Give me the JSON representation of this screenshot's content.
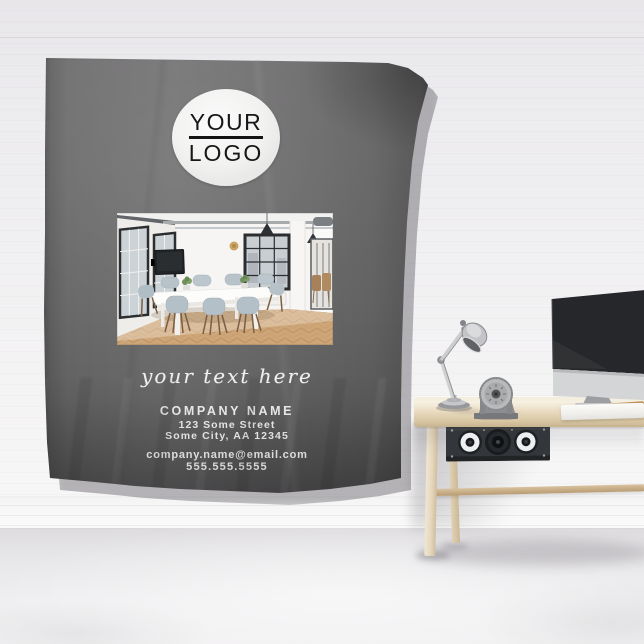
{
  "tapestry": {
    "logo": {
      "line1": "YOUR",
      "line2": "LOGO"
    },
    "tagline": "your text here",
    "company": {
      "name": "COMPANY NAME",
      "address_line1": "123 Some Street",
      "address_line2": "Some City, AA 12345",
      "email": "company.name@email.com",
      "phone": "555.555.5555"
    },
    "colors": {
      "fabric_gray": "#6f6f70",
      "fabric_shadow": "#4f4f50",
      "print_text": "#f0f0f0",
      "logo_circle_bg": "#f6f6f6",
      "logo_text": "#171717"
    }
  },
  "scene": {
    "colors": {
      "wall": "#efeef1",
      "floor": "#e9e8ea",
      "desk_wood": "#eee3cc",
      "desk_legs": "#e6d9bf",
      "speaker_cabinet": "#34373b",
      "monitor_screen": "#26272a",
      "monitor_chin": "#d0d1d3",
      "lamp_metal": "#c6c7c9",
      "keyboard": "#f4f3f1"
    },
    "photo_room": {
      "floor_wood": "#cda577",
      "chair_seat": "#b4c0c7",
      "window_frame": "#2c2f31",
      "wall_clock": "#c9a466"
    }
  }
}
